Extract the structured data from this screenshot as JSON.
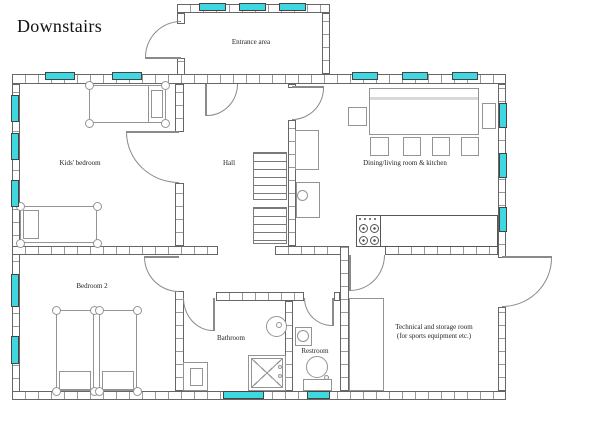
{
  "title": "Downstairs",
  "rooms": {
    "entrance": "Entrance area",
    "kids": "Kids' bedroom",
    "hall": "Hall",
    "dining": "Dining/living room & kitchen",
    "bedroom2": "Bedroom 2",
    "bathroom": "Bathroom",
    "restroom": "Restroom",
    "technical_line1": "Technical and storage room",
    "technical_line2": "(for sports equipment etc.)"
  },
  "colors": {
    "window": "#3fd8e0",
    "wall": "#666666",
    "tick": "#9a9a9a",
    "furn": "#949494",
    "dark": "#555555",
    "door": "#8a8a8a",
    "text": "#1f1f1f"
  }
}
